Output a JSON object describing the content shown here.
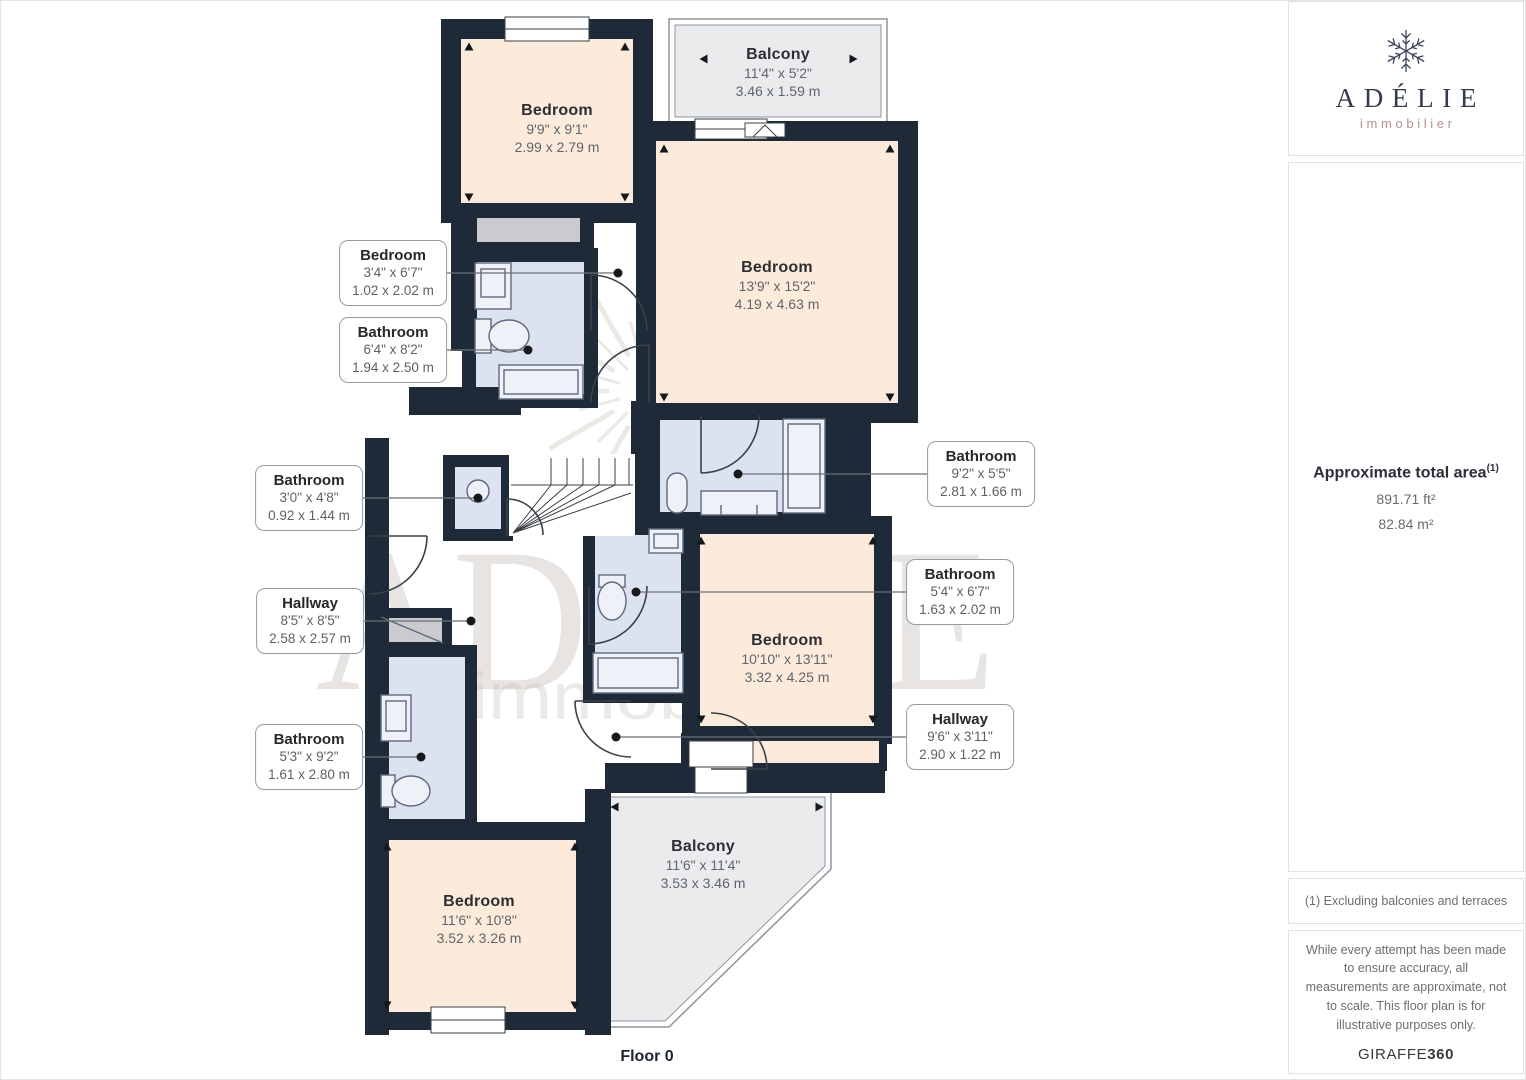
{
  "floorplan": {
    "floor_label": "Floor 0",
    "rooms": [
      {
        "id": "bedroom-top-left",
        "name": "Bedroom",
        "dim_ft": "9'9\" x 9'1\"",
        "dim_m": "2.99 x 2.79 m"
      },
      {
        "id": "balcony-top",
        "name": "Balcony",
        "dim_ft": "11'4\" x 5'2\"",
        "dim_m": "3.46 x 1.59 m"
      },
      {
        "id": "bedroom-large",
        "name": "Bedroom",
        "dim_ft": "13'9\" x 15'2\"",
        "dim_m": "4.19 x 4.63 m"
      },
      {
        "id": "bedroom-mid",
        "name": "Bedroom",
        "dim_ft": "10'10\" x 13'11\"",
        "dim_m": "3.32 x 4.25 m"
      },
      {
        "id": "bedroom-bottom",
        "name": "Bedroom",
        "dim_ft": "11'6\" x 10'8\"",
        "dim_m": "3.52 x 3.26 m"
      },
      {
        "id": "balcony-bottom",
        "name": "Balcony",
        "dim_ft": "11'6\" x 11'4\"",
        "dim_m": "3.53 x 3.46 m"
      }
    ],
    "callouts": [
      {
        "id": "bedroom-small",
        "name": "Bedroom",
        "dim_ft": "3'4\" x 6'7\"",
        "dim_m": "1.02 x 2.02 m"
      },
      {
        "id": "bathroom-ensuite",
        "name": "Bathroom",
        "dim_ft": "6'4\" x 8'2\"",
        "dim_m": "1.94 x 2.50 m"
      },
      {
        "id": "bathroom-right",
        "name": "Bathroom",
        "dim_ft": "9'2\" x 5'5\"",
        "dim_m": "2.81 x 1.66 m"
      },
      {
        "id": "bathroom-mid",
        "name": "Bathroom",
        "dim_ft": "5'4\" x 6'7\"",
        "dim_m": "1.63 x 2.02 m"
      },
      {
        "id": "bathroom-left",
        "name": "Bathroom",
        "dim_ft": "3'0\" x 4'8\"",
        "dim_m": "0.92 x 1.44 m"
      },
      {
        "id": "hallway-left",
        "name": "Hallway",
        "dim_ft": "8'5\" x 8'5\"",
        "dim_m": "2.58 x 2.57 m"
      },
      {
        "id": "bathroom-bottom-left",
        "name": "Bathroom",
        "dim_ft": "5'3\" x 9'2\"",
        "dim_m": "1.61 x 2.80 m"
      },
      {
        "id": "hallway-right",
        "name": "Hallway",
        "dim_ft": "9'6\" x 3'11\"",
        "dim_m": "2.90 x 1.22 m"
      }
    ]
  },
  "watermark": {
    "text": "ADÉLIE",
    "subtext": "immobilier"
  },
  "sidebar": {
    "logo": {
      "brand": "ADÉLIE",
      "subtitle": "immobilier"
    },
    "area": {
      "title": "Approximate total area",
      "footnote_marker": "(1)",
      "value_ft": "891.71 ft²",
      "value_m": "82.84 m²"
    },
    "footnote": "(1) Excluding balconies and terraces",
    "disclaimer": "While every attempt has been made to ensure accuracy, all measurements are approximate, not to scale. This floor plan is for illustrative purposes only.",
    "branding": {
      "name": "GIRAFFE",
      "suffix": "360"
    }
  },
  "colors": {
    "wall": "#1e2a38",
    "bedroom_fill": "#fcebda",
    "bathroom_fill": "#dce2ef",
    "closet_fill": "#c9cbce",
    "balcony_fill": "#eaebed",
    "accent_sub": "#b59090"
  }
}
